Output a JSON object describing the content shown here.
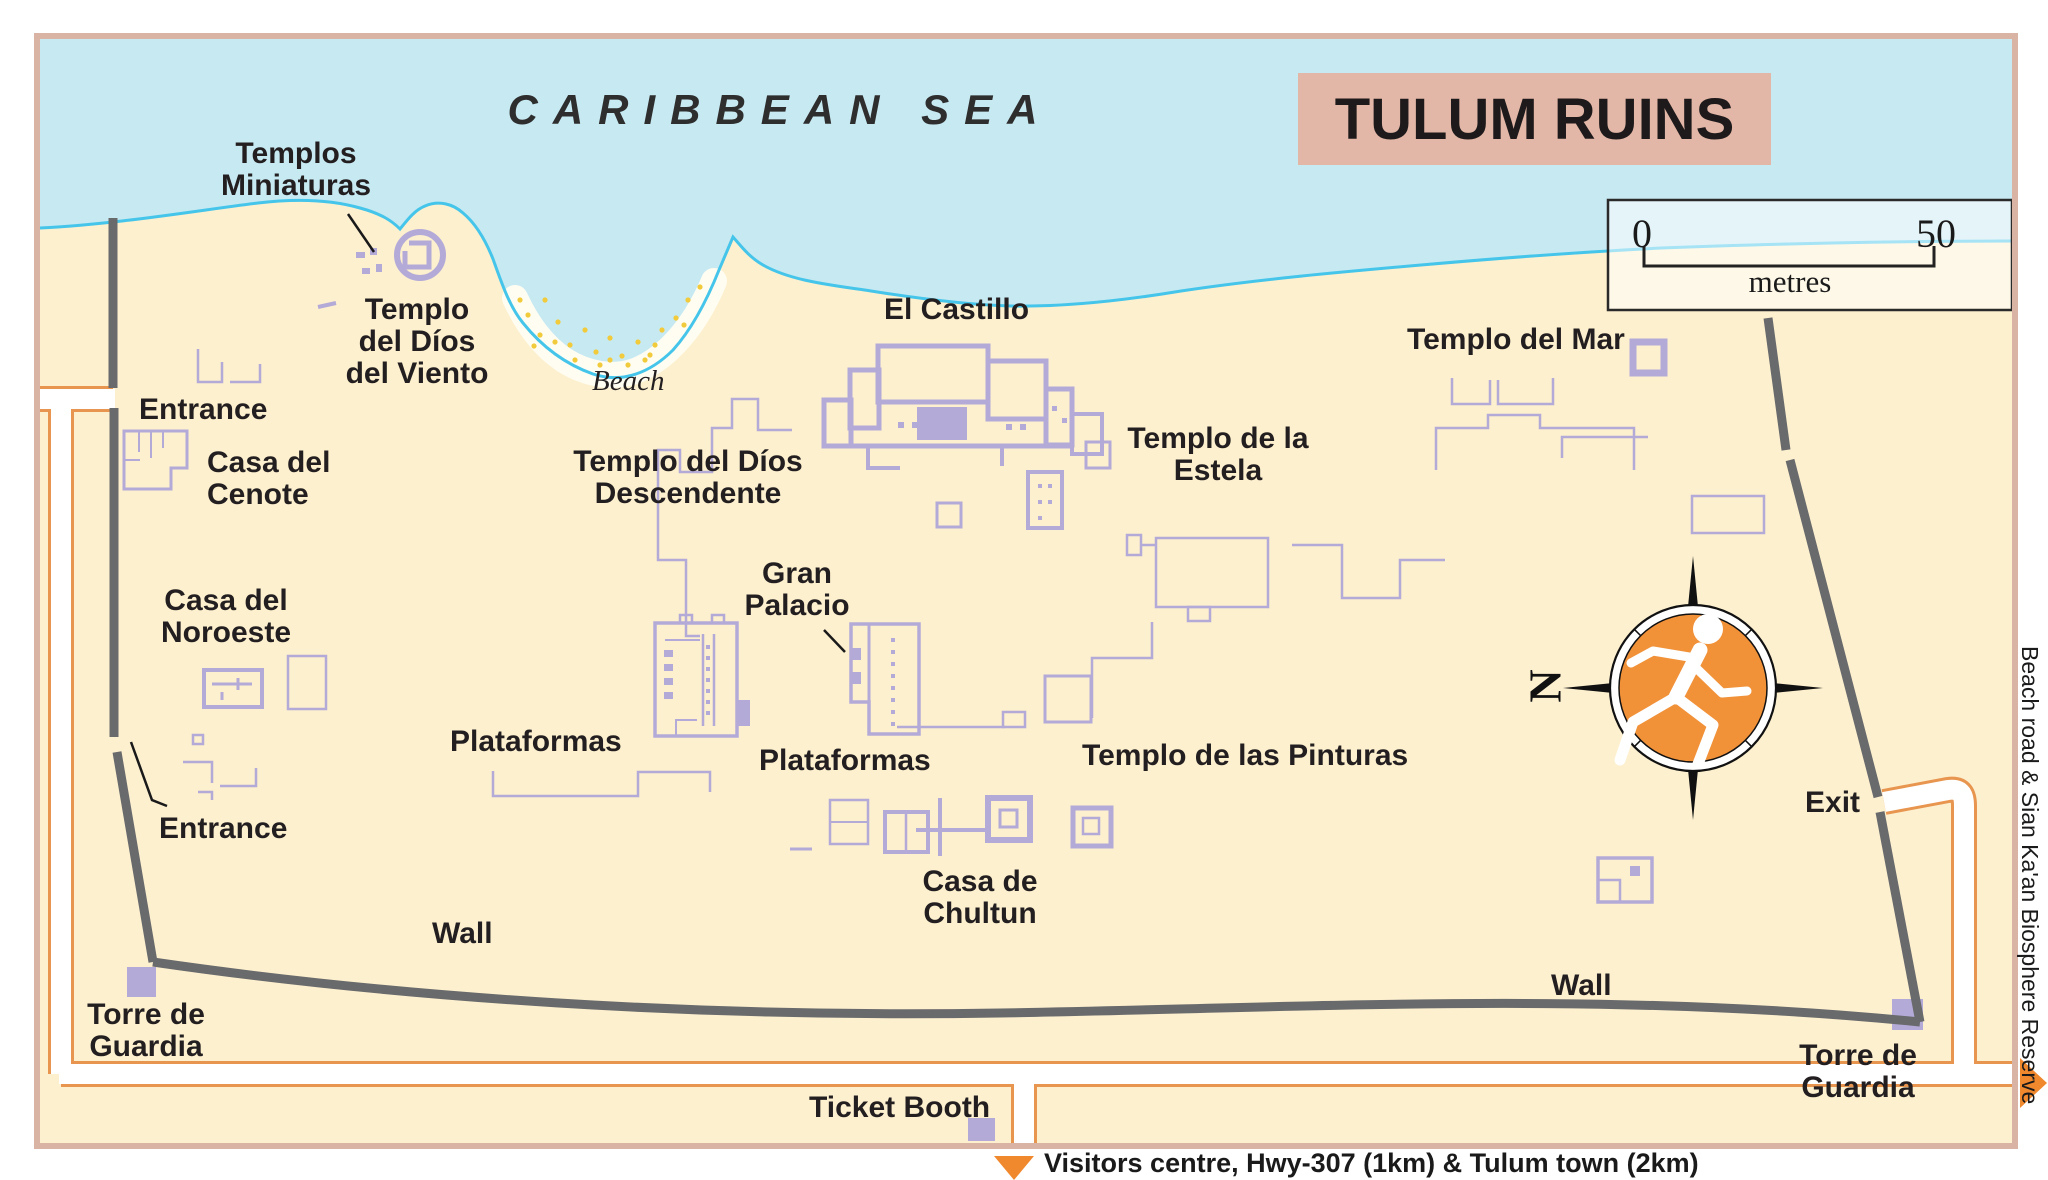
{
  "title": "TULUM RUINS",
  "sea_label": "CARIBBEAN SEA",
  "beach_label": "Beach",
  "scale": {
    "start": "0",
    "end": "50",
    "unit": "metres"
  },
  "compass": {
    "north": "N"
  },
  "labels": {
    "templos_miniaturas": "Templos\nMiniaturas",
    "templo_del_dios_del_viento": "Templo\ndel Díos\ndel Viento",
    "entrance_north": "Entrance",
    "casa_del_cenote": "Casa del\nCenote",
    "casa_del_noroeste": "Casa del\nNoroeste",
    "entrance_west": "Entrance",
    "torre_de_guardia_west": "Torre de\nGuardia",
    "wall_west": "Wall",
    "wall_east": "Wall",
    "ticket_booth": "Ticket Booth",
    "torre_de_guardia_east": "Torre de\nGuardia",
    "exit": "Exit",
    "el_castillo": "El Castillo",
    "templo_del_dios_descendente": "Templo del Díos\nDescendente",
    "gran_palacio": "Gran\nPalacio",
    "plataformas_west": "Plataformas",
    "plataformas_center": "Plataformas",
    "templo_de_la_estela": "Templo de la\nEstela",
    "templo_del_mar": "Templo del Mar",
    "templo_de_las_pinturas": "Templo de las Pinturas",
    "casa_de_chultun": "Casa de\nChultun"
  },
  "captions": {
    "south": "Visitors centre, Hwy-307 (1km) & Tulum town (2km)",
    "east": "Beach road & Sian Ka'an Biosphere Reserve"
  },
  "colors": {
    "sea": "#c7e9f2",
    "land": "#fdf0cf",
    "coast": "#45c5ea",
    "ruin": "#b4aad7",
    "wall": "#696a6c",
    "path_casing": "#e8954f",
    "banner": "#e3b7a7",
    "accent_orange": "#f0882e",
    "compass_orange": "#f19138",
    "border": "#d9b3a3"
  }
}
